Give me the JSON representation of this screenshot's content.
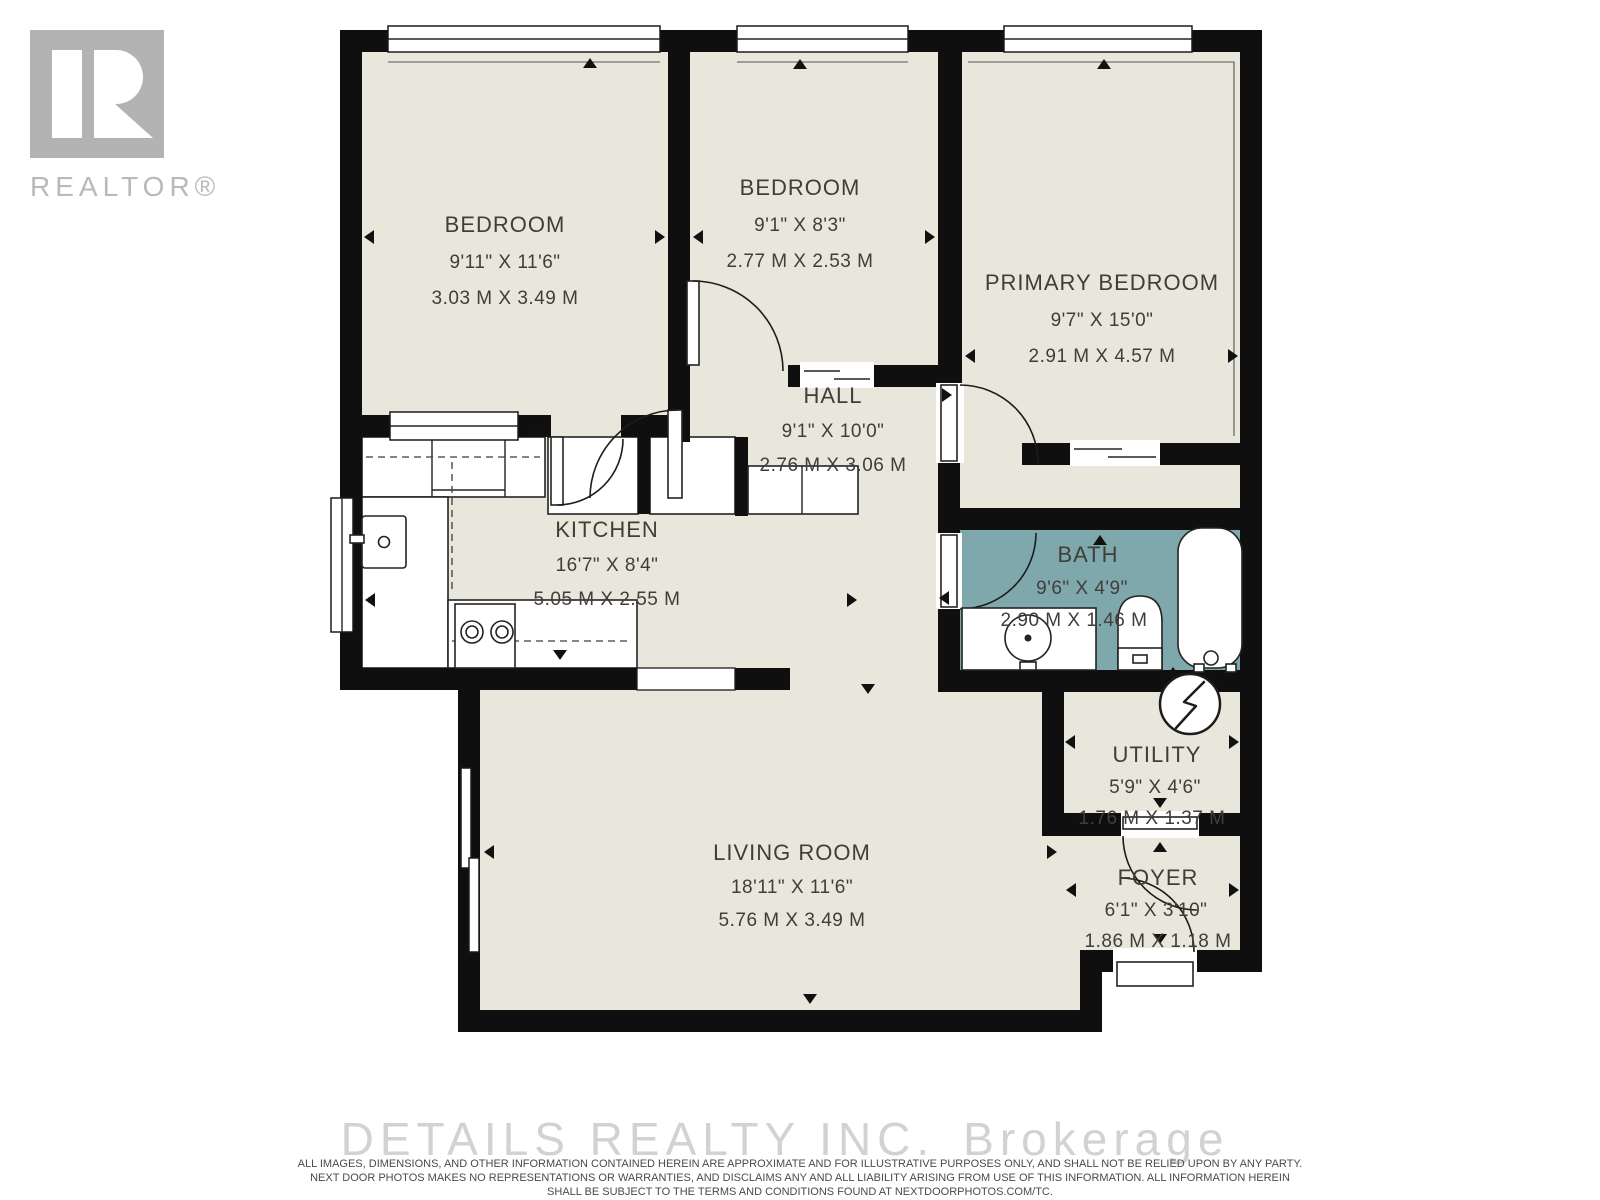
{
  "branding": {
    "realtor_text": "REALTOR®"
  },
  "watermark": {
    "company": "DETAILS REALTY INC.",
    "suffix": "Brokerage"
  },
  "disclaimer": {
    "line1": "ALL IMAGES, DIMENSIONS, AND OTHER INFORMATION CONTAINED HEREIN ARE APPROXIMATE AND FOR ILLUSTRATIVE PURPOSES ONLY, AND SHALL NOT BE RELIED UPON BY ANY PARTY.",
    "line2": "NEXT DOOR PHOTOS MAKES NO REPRESENTATIONS OR WARRANTIES, AND DISCLAIMS ANY AND ALL LIABILITY ARISING FROM USE OF THIS INFORMATION. ALL INFORMATION HEREIN",
    "line3": "SHALL BE SUBJECT TO THE TERMS AND CONDITIONS FOUND AT NEXTDOORPHOTOS.COM/TC."
  },
  "colors": {
    "wall": "#0f0f0f",
    "floor": "#e9e6dc",
    "bath": "#7fa8ac",
    "label": "#403e39",
    "watermark": "#d2d2d2",
    "logo_gray": "#b3b3b3"
  },
  "rooms": [
    {
      "id": "bedroom-1",
      "name": "BEDROOM",
      "imperial": "9'11\" X 11'6\"",
      "metric": "3.03 M X 3.49 M"
    },
    {
      "id": "bedroom-2",
      "name": "BEDROOM",
      "imperial": "9'1\" X 8'3\"",
      "metric": "2.77 M X 2.53 M"
    },
    {
      "id": "primary-bedroom",
      "name": "PRIMARY BEDROOM",
      "imperial": "9'7\" X 15'0\"",
      "metric": "2.91 M X 4.57 M"
    },
    {
      "id": "hall",
      "name": "HALL",
      "imperial": "9'1\" X 10'0\"",
      "metric": "2.76 M X 3.06 M"
    },
    {
      "id": "kitchen",
      "name": "KITCHEN",
      "imperial": "16'7\" X 8'4\"",
      "metric": "5.05 M X 2.55 M"
    },
    {
      "id": "bath",
      "name": "BATH",
      "imperial": "9'6\" X 4'9\"",
      "metric": "2.90 M X 1.46 M"
    },
    {
      "id": "living-room",
      "name": "LIVING ROOM",
      "imperial": "18'11\" X 11'6\"",
      "metric": "5.76 M X 3.49 M"
    },
    {
      "id": "utility",
      "name": "UTILITY",
      "imperial": "5'9\" X 4'6\"",
      "metric": "1.76 M X 1.37 M"
    },
    {
      "id": "foyer",
      "name": "FOYER",
      "imperial": "6'1\" X 3'10\"",
      "metric": "1.86 M X 1.18 M"
    }
  ]
}
